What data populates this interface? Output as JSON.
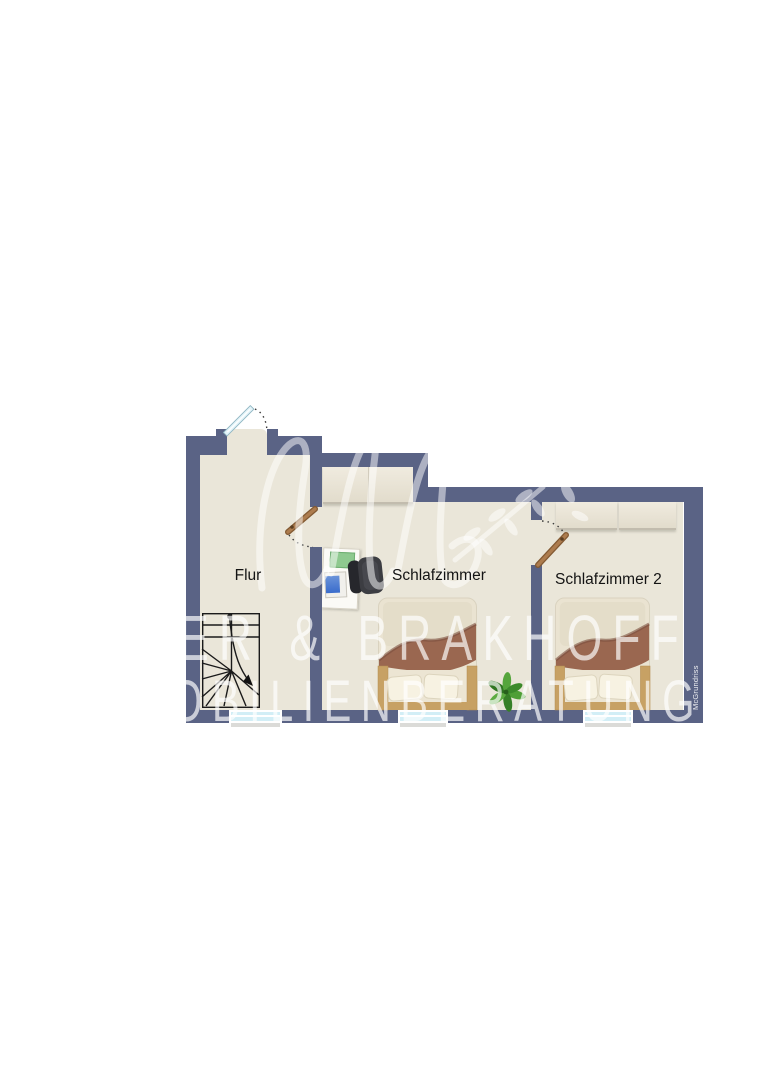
{
  "floorplan": {
    "type": "apartment-floor-plan",
    "rooms": [
      {
        "id": "flur",
        "label": "Flur"
      },
      {
        "id": "schlafzimmer",
        "label": "Schlafzimmer"
      },
      {
        "id": "schlafzimmer2",
        "label": "Schlafzimmer 2"
      }
    ],
    "watermark": {
      "monogram": "uhb-script-logo-with-leaf-branch",
      "line1": "ER & BRAKHOFF",
      "line2": "OBILIENBERATUNG"
    },
    "credit": "McGrundriss",
    "furniture": [
      "staircase-with-walk-line",
      "double-bed",
      "double-bed",
      "desk",
      "desk-pad",
      "laptop",
      "office-chair",
      "wardrobe",
      "cabinet",
      "cabinet",
      "plant",
      "window",
      "window",
      "window",
      "entrance-door",
      "interior-door",
      "interior-door"
    ],
    "colors": {
      "wall": "#5a6385",
      "floor": "#eae6d9",
      "window_glass": "#d2eef6",
      "entrance_door": "#e4f4f9",
      "interior_door_wood": "#a5774a",
      "bed_blanket": "#9a6750",
      "bed_wood": "#c7a164",
      "plant_green": "#4f9f37",
      "watermark": "#ffffff",
      "background": "#ffffff"
    }
  }
}
